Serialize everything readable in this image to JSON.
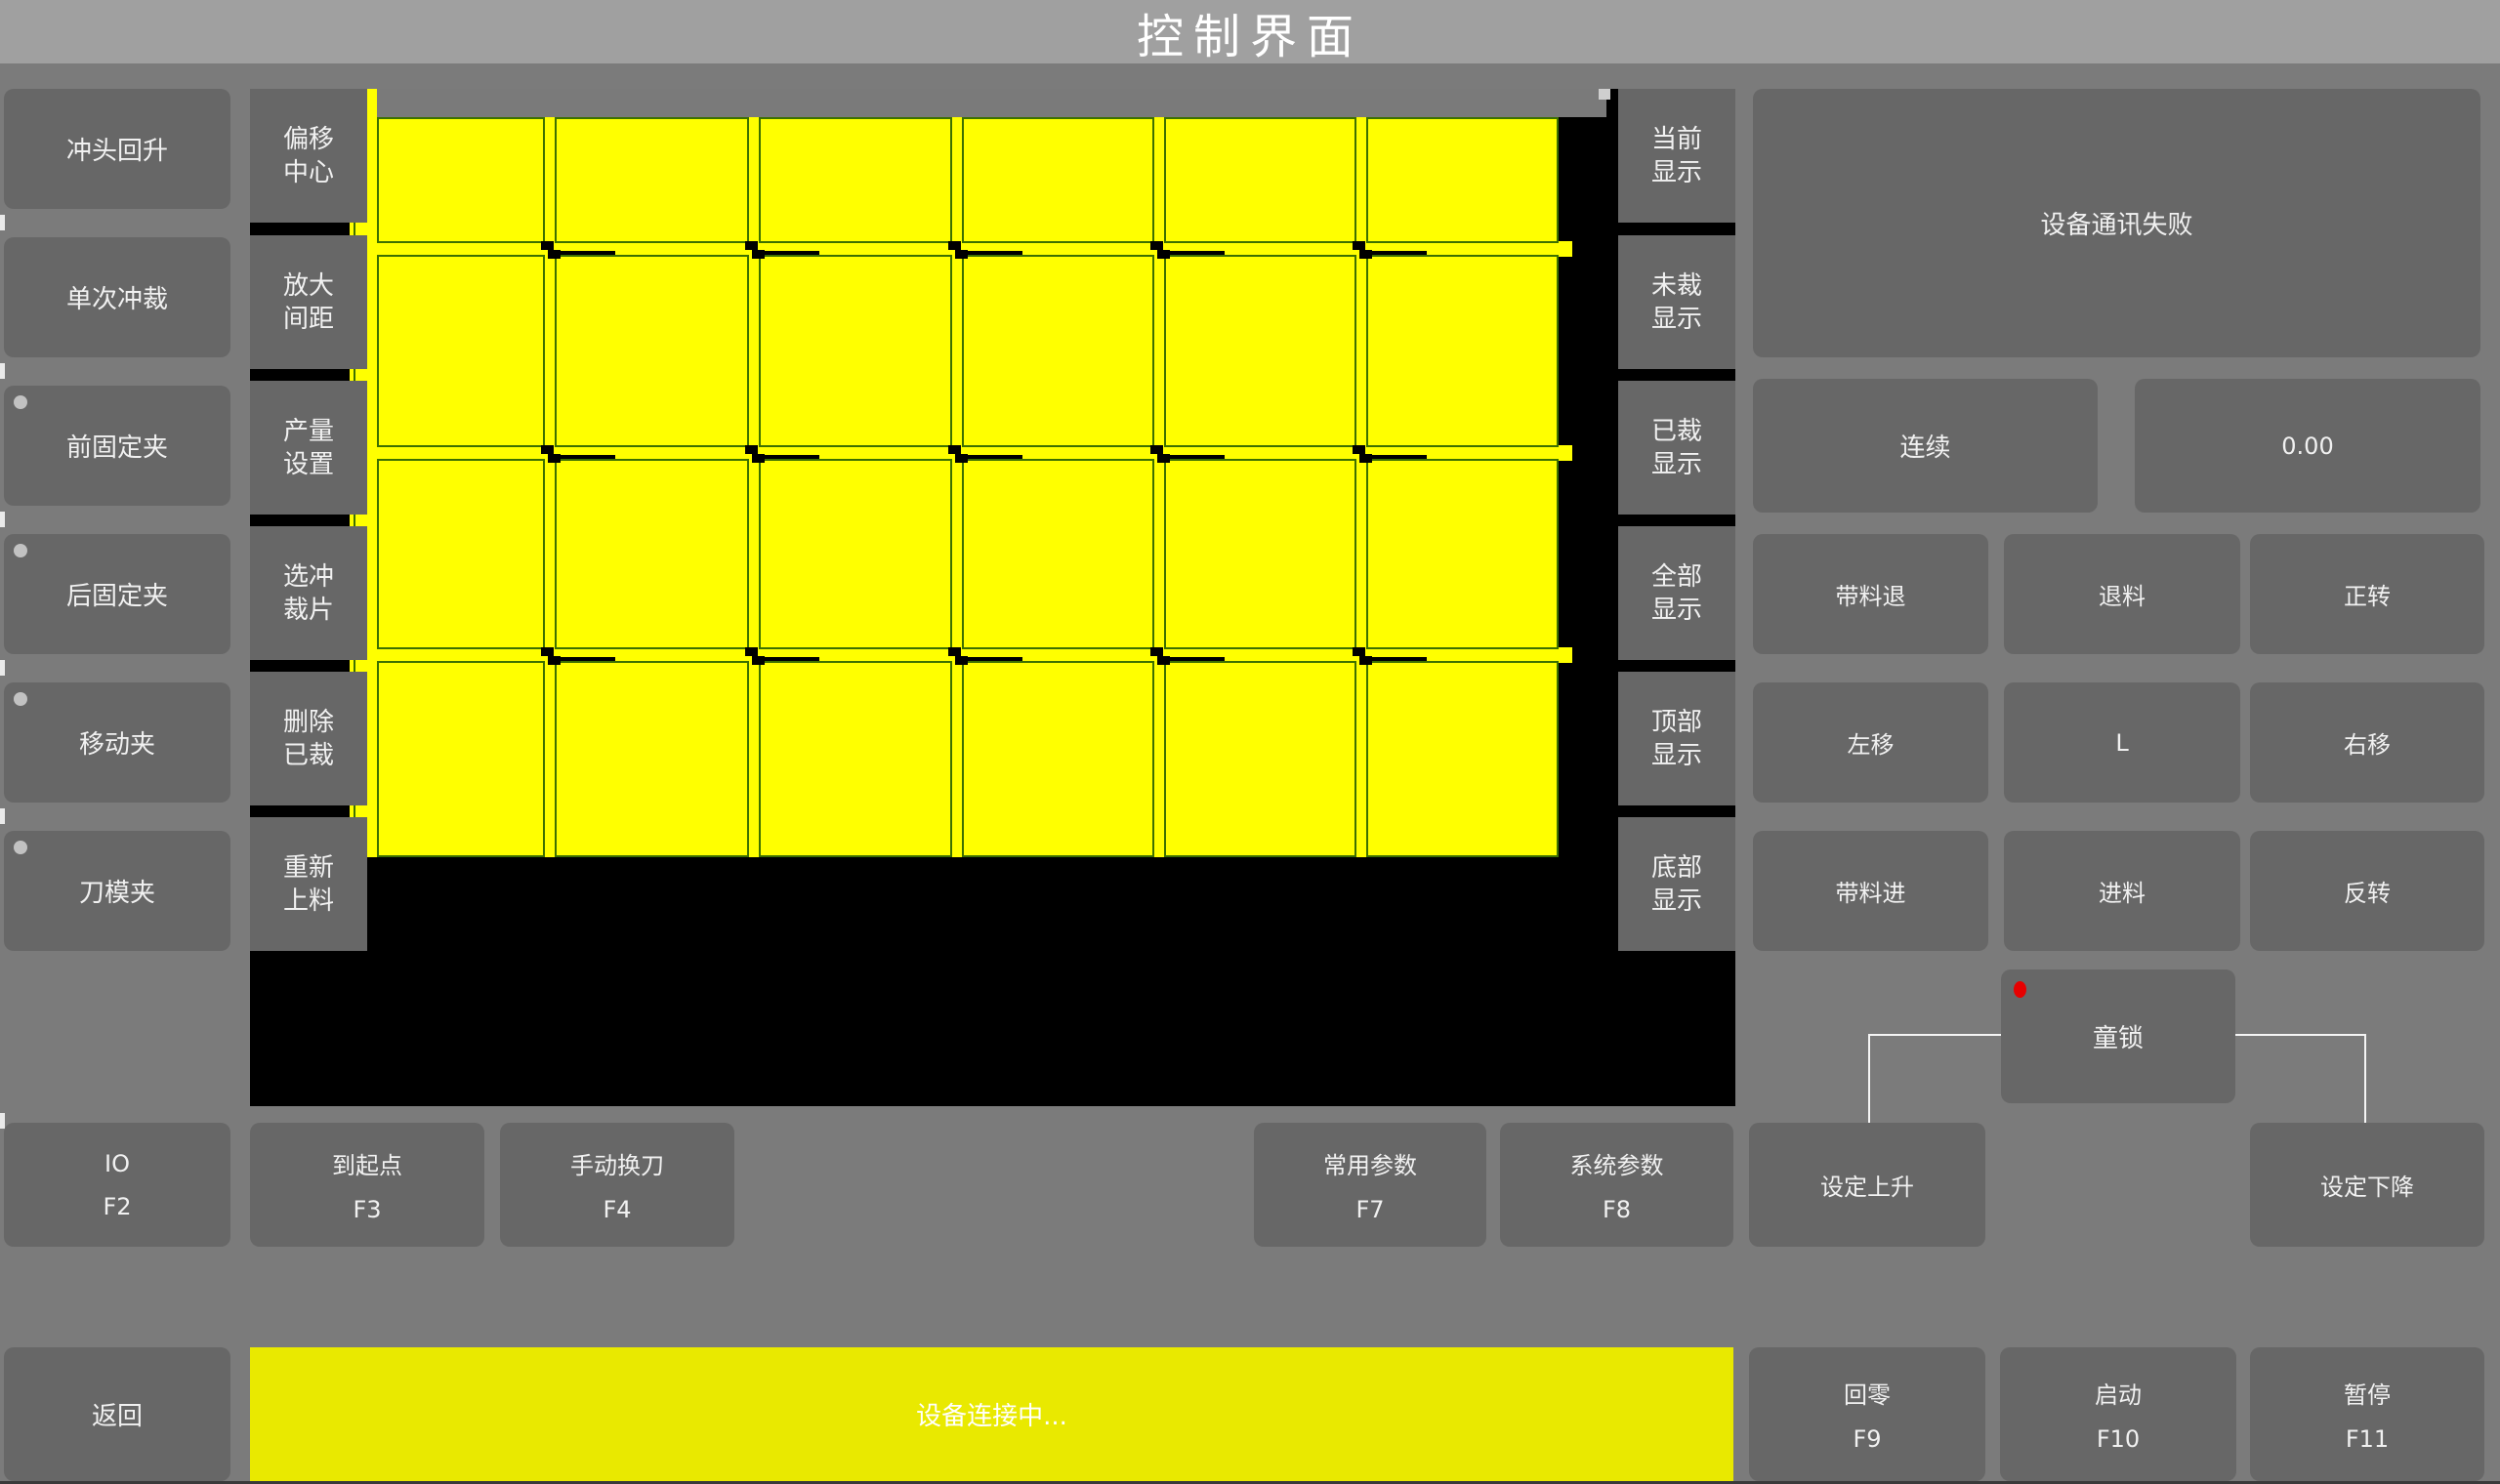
{
  "title": "控制界面",
  "left_panel": {
    "buttons": [
      {
        "label": "冲头回升",
        "indicator": false
      },
      {
        "label": "单次冲裁",
        "indicator": false
      },
      {
        "label": "前固定夹",
        "indicator": true
      },
      {
        "label": "后固定夹",
        "indicator": true
      },
      {
        "label": "移动夹",
        "indicator": true
      },
      {
        "label": "刀模夹",
        "indicator": true
      }
    ]
  },
  "tool_column": {
    "buttons": [
      "偏移\n中心",
      "放大\n间距",
      "产量\n设置",
      "选冲\n裁片",
      "删除\n已裁",
      "重新\n上料"
    ]
  },
  "display_column": {
    "buttons": [
      "当前\n显示",
      "未裁\n显示",
      "已裁\n显示",
      "全部\n显示",
      "顶部\n显示",
      "底部\n显示"
    ]
  },
  "status_panel": {
    "message": "设备通讯失败",
    "mode_button": "连续",
    "value_display": "0.00",
    "jog_buttons": [
      "带料退",
      "退料",
      "正转",
      "左移",
      "L",
      "右移",
      "带料进",
      "进料",
      "反转"
    ],
    "child_lock_button": "童锁"
  },
  "function_row": {
    "keys": [
      {
        "label": "IO",
        "key": "F2"
      },
      {
        "label": "到起点",
        "key": "F3"
      },
      {
        "label": "手动换刀",
        "key": "F4"
      },
      {
        "label": "常用参数",
        "key": "F7"
      },
      {
        "label": "系统参数",
        "key": "F8"
      }
    ],
    "set_rise_button": "设定上升",
    "set_fall_button": "设定下降"
  },
  "bottom_bar": {
    "back_button": "返回",
    "status_message": "设备连接中...",
    "keys": [
      {
        "label": "回零",
        "key": "F9"
      },
      {
        "label": "启动",
        "key": "F10"
      },
      {
        "label": "暂停",
        "key": "F11"
      }
    ]
  },
  "sheet_view": {
    "rows": 4,
    "cols": 6,
    "sheet_color": "#ffff00",
    "piece_outline_color": "#3c7000",
    "canvas_color": "#000000"
  },
  "colors": {
    "accent_yellow": "#e9e900",
    "button_gray": "#676767",
    "background_gray": "#7b7b7b",
    "titlebar_gray": "#a0a0a0",
    "status_red": "#e60000"
  }
}
